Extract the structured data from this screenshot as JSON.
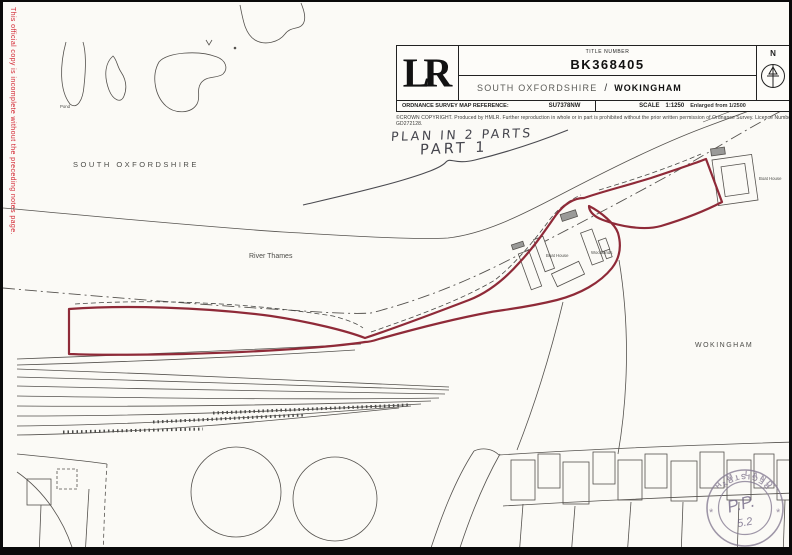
{
  "page": {
    "side_note": "This official copy is incomplete without the preceding notes page.",
    "paper_color": "#fbfaf6",
    "border_color": "#0a0a0a"
  },
  "header": {
    "logo": "LR",
    "title_number_label": "TITLE NUMBER",
    "title_number": "BK368405",
    "district": "SOUTH OXFORDSHIRE",
    "district_separator": "/",
    "borough": "WOKINGHAM",
    "os_ref_label": "ORDNANCE SURVEY MAP REFERENCE:",
    "os_ref": "SU7378NW",
    "scale_label": "SCALE",
    "scale_value": "1:1250",
    "scale_note": "Enlarged from 1/2500",
    "north_label": "N",
    "copyright": "©CROWN COPYRIGHT. Produced by HMLR. Further reproduction in whole or in part is prohibited without the prior written permission of Ordnance Survey. Licence Number GD272128."
  },
  "annotations": {
    "plan_note_line1": "PLAN IN 2 PARTS",
    "plan_note_line2": "PART 1"
  },
  "map": {
    "labels": {
      "county_left": "SOUTH OXFORDSHIRE",
      "river": "River Thames",
      "borough_right": "WOKINGHAM",
      "pond": "Pond",
      "boat_house_1": "Boat House",
      "building_2": "Woodlands",
      "boat_house_3": "Boat House"
    },
    "boundary_color": "#8f2a38",
    "line_color": "#55524e"
  },
  "stamp": {
    "arc_top": "H.M. LAND",
    "arc_bottom": "REGISTRY",
    "star_left": "*",
    "star_right": "*",
    "handwritten_initials": "P.P.",
    "handwritten_number": "5.2",
    "color": "#857a92"
  }
}
